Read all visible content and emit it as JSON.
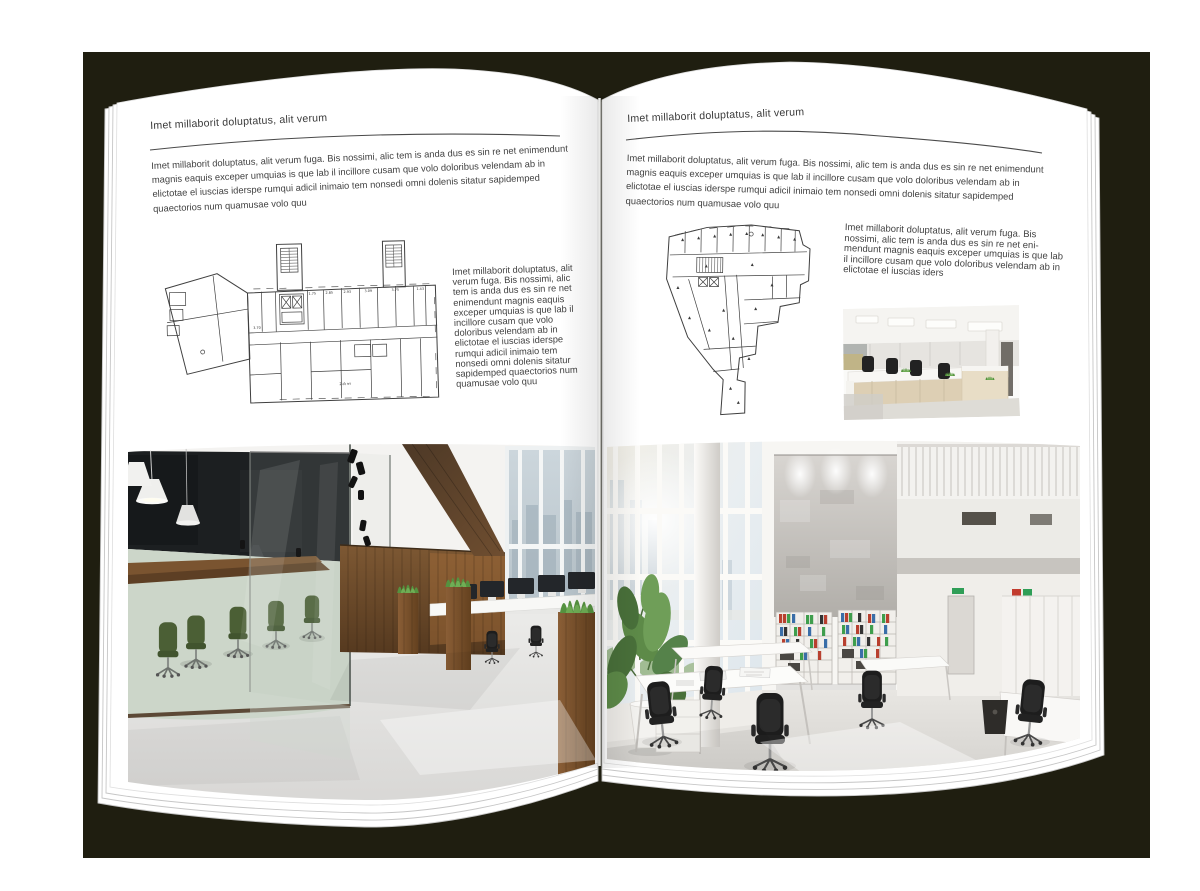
{
  "canvas": {
    "background": "#ffffff",
    "backdrop_color": "#1f1e10"
  },
  "book": {
    "left_page": {
      "header": "Imet millaborit doluptatus, alit verum",
      "intro": "Imet millaborit doluptatus, alit verum fuga. Bis nossimi, alic tem is anda dus es sin re net enimendunt magnis eaquis exceper umquias is que lab il incillore cusam que volo doloribus velendam ab in elictotae el iuscias iderspe rumqui adicil inimaio tem nonsedi omni dolenis sitatur sapidemped quaectorios num quamusae volo quu",
      "caption": "Imet millaborit doluptatus, alit verum fuga. Bis nossimi, alic tem is anda dus es sin re net enimendunt magnis eaquis exceper umquias is que lab il incillore cusam que volo doloribus velendam ab in elictotae el iuscias iderspe rumqui adicil inimaio tem nonsedi omni dolenis sitatur sapidemped quaectorios num quamusae volo quu",
      "floor_plan_labels": [
        "1.75",
        "2.85",
        "2.93",
        "3.09",
        "3.75",
        "1.43",
        "3.70",
        "2-й эт"
      ],
      "floor_plan_name": "architectural-floor-plan-rectangular-building",
      "photo_name": "office-photo-dark-wood-glass-meeting-room"
    },
    "right_page": {
      "header": "Imet millaborit doluptatus, alit verum",
      "intro": "Imet millaborit doluptatus, alit verum fuga. Bis nossimi, alic tem is anda dus es sin re net enimendunt magnis eaquis exceper umquias is que lab il incillore cusam que volo doloribus velendam ab in elictotae el iuscias iderspe rumqui adicil inimaio tem nonsedi omni dolenis sitatur sapidemped quaectorios num quamusae volo quu",
      "caption": "Imet millaborit doluptatus, alit verum fuga. Bis nossimi, alic tem is anda dus es sin re net eni-mendunt magnis eaquis exceper umquias is que lab il incillore cusam que volo doloribus velendam ab in elictotae el iuscias iders",
      "floor_plan_name": "architectural-floor-plan-irregular-building",
      "photo_small_name": "office-photo-open-space-workstations",
      "photo_name": "office-photo-bright-atrium-white-desks"
    }
  }
}
